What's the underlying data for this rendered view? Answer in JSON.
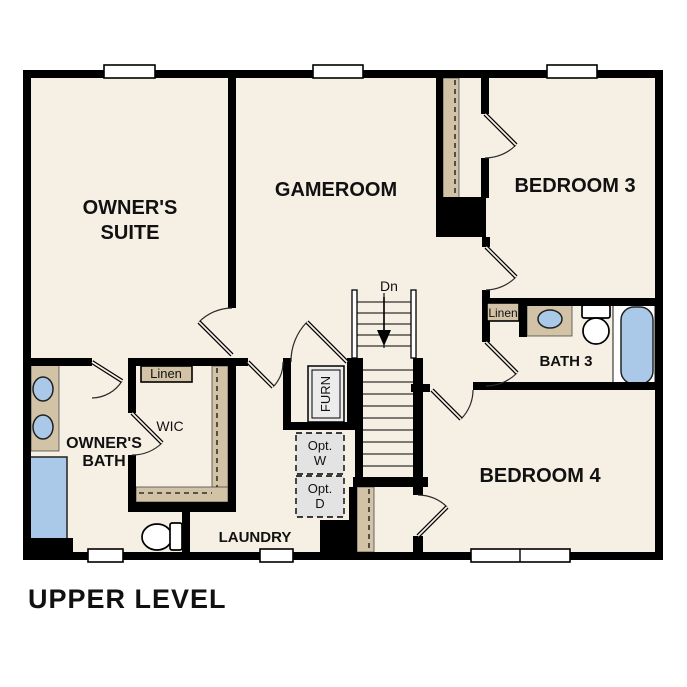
{
  "plan_title": "UPPER LEVEL",
  "stairs": {
    "direction_label": "Dn"
  },
  "rooms": {
    "owners_suite": {
      "line1": "OWNER'S",
      "line2": "SUITE"
    },
    "gameroom": {
      "label": "GAMEROOM"
    },
    "bedroom3": {
      "label": "BEDROOM 3"
    },
    "bedroom4": {
      "label": "BEDROOM 4"
    },
    "bath3": {
      "label": "BATH 3"
    },
    "owners_bath": {
      "line1": "OWNER'S",
      "line2": "BATH"
    },
    "wic": {
      "label": "WIC"
    },
    "laundry": {
      "label": "LAUNDRY"
    }
  },
  "closets": {
    "wic_linen": {
      "label": "Linen"
    },
    "bath3_linen": {
      "label": "Linen"
    }
  },
  "utility": {
    "furnace": {
      "label": "FURN"
    },
    "optional_washer": {
      "line1": "Opt.",
      "line2": "W"
    },
    "optional_dryer": {
      "line1": "Opt.",
      "line2": "D"
    }
  },
  "colors": {
    "floor": "#f6efe4",
    "walls": "#000000",
    "casework_tan": "#d2c3a6",
    "fixture_blue": "#aac9e9",
    "optional_gray": "#e3e3e3",
    "window_white": "#ffffff"
  }
}
